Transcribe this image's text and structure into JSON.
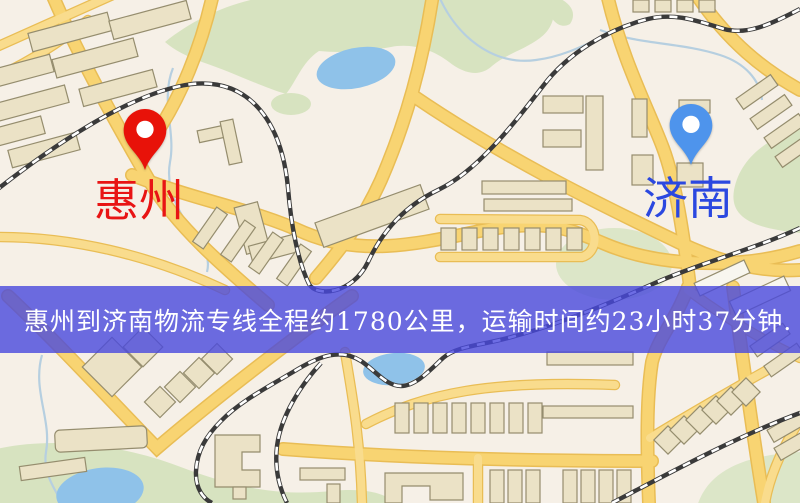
{
  "map": {
    "origin_marker": {
      "label": "惠州",
      "icon": "red-location-pin",
      "pin_color": "#e81209",
      "label_color": "#e81414"
    },
    "destination_marker": {
      "label": "济南",
      "icon": "blue-location-pin",
      "pin_color": "#4e94ec",
      "label_color": "#2b48e0"
    }
  },
  "banner": {
    "text": "惠州到济南物流专线全程约1780公里，运输时间约23小时37分钟.",
    "background_color": "rgba(72,73,221,0.8)",
    "text_color": "#ffffff"
  }
}
